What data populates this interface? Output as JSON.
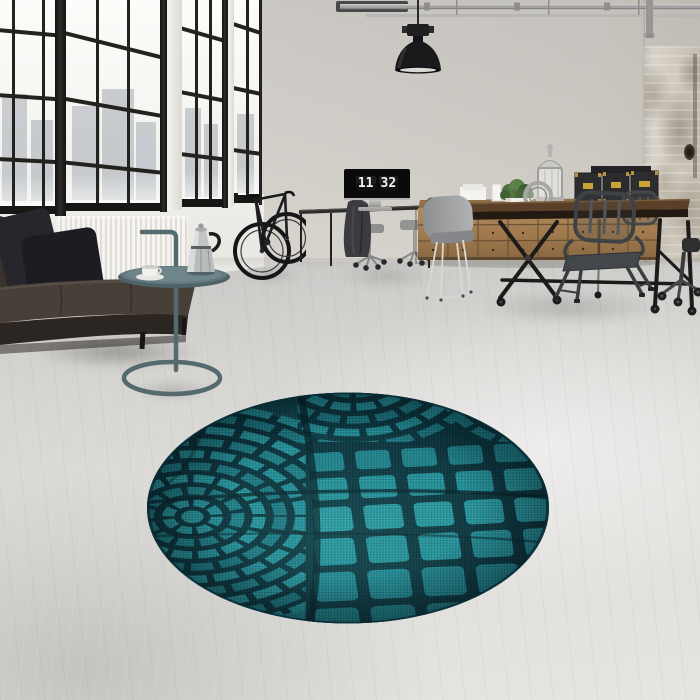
{
  "meta": {
    "description": "Industrial loft interior: black factory windows, leather sofa, side table with moka pot, bicycle, desk monitor showing a flip clock, pendant lamp, ceiling pipes, wooden drawer sideboard with storage boxes, industrial dining table with grey chairs, distressed plaster wall, and a round teal woven rug on a concrete floor"
  },
  "clock": {
    "hours": "11",
    "minutes": "32"
  },
  "palette": {
    "wall": "#e7e5e2",
    "floor": "#d6d5d2",
    "window_frame": "#1d1d1c",
    "daylight": "#f6f6f3",
    "city_silhouette": "#949ca6",
    "sofa_leather": "#38302a",
    "pillow_dark": "#1f1f24",
    "radiator_white": "#f3f1ee",
    "side_table_teal": "#546a6e",
    "moka_silver": "#b9bcbd",
    "bike_black": "#1a1a1c",
    "lamp_black": "#17171a",
    "pipe_grey": "#a3a2a0",
    "wood_sideboard": "#a6815c",
    "table_wood_dark": "#5a4029",
    "metal_chair_grey": "#3f4245",
    "eames_chair_grey": "#9aa0a2",
    "box_dark": "#2d2d30",
    "box_brass": "#c9a23a",
    "distressed_plaster": "#9a9184",
    "rug_teal": "#239099",
    "rug_dark": "#0a2e38"
  },
  "objects": [
    "window-wall",
    "radiator",
    "leather-sofa",
    "sofa-pillows",
    "side-table",
    "moka-pot",
    "espresso-cup",
    "bicycle",
    "wall-rack",
    "desk",
    "monitor-flip-clock",
    "office-chairs",
    "draped-jacket",
    "pendant-lamp",
    "ceiling-pipes",
    "drawer-sideboard",
    "storage-boxes",
    "lantern",
    "potted-plant",
    "round-ornament",
    "picture-frames",
    "dining-table",
    "eames-chair",
    "metal-armchairs",
    "distressed-wall",
    "office-chair-base",
    "round-teal-rug",
    "concrete-floor",
    "city-view"
  ]
}
